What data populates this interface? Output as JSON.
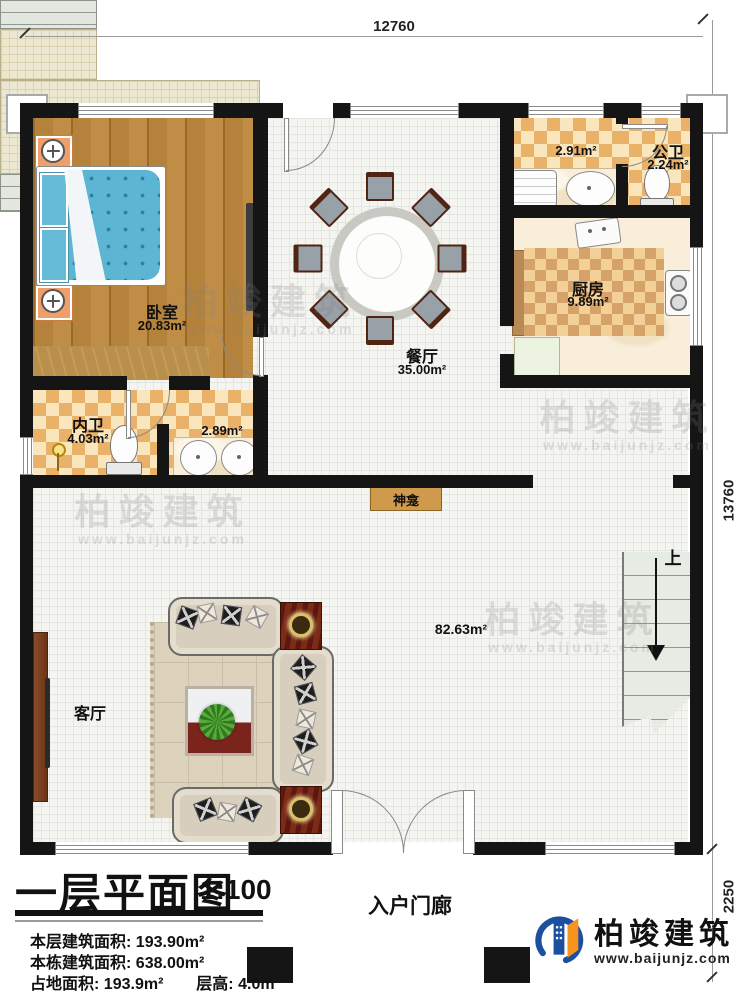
{
  "plan": {
    "dimensions": {
      "top": "12760",
      "right": "13760",
      "porch_depth": "2250"
    },
    "rooms": {
      "bedroom": {
        "name": "卧室",
        "area": "20.83m²"
      },
      "dining": {
        "name": "餐厅",
        "area": "35.00m²"
      },
      "laundry": {
        "area": "2.91m²"
      },
      "public_bath": {
        "name": "公卫",
        "area": "2.24m²"
      },
      "kitchen": {
        "name": "厨房",
        "area": "9.89m²"
      },
      "private_bath": {
        "name": "内卫",
        "area": "4.03m²"
      },
      "vanity": {
        "area": "2.89m²"
      },
      "hall": {
        "area": "82.63m²"
      },
      "living": {
        "name": "客厅"
      },
      "shrine": {
        "name": "神龛"
      },
      "entry_porch": {
        "name": "入户门廊"
      },
      "stairs": {
        "up": "上"
      }
    }
  },
  "title_block": {
    "title": "一层平面图",
    "scale": "1:100",
    "stats": [
      {
        "label": "本层建筑面积:",
        "value": "193.90m²"
      },
      {
        "label": "本栋建筑面积:",
        "value": "638.00m²"
      },
      {
        "label": "占地面积:",
        "value": "193.9m²",
        "label2": "层高:",
        "value2": "4.0m"
      }
    ]
  },
  "branding": {
    "company": "柏竣建筑",
    "website": "www.baijunjz.com"
  }
}
